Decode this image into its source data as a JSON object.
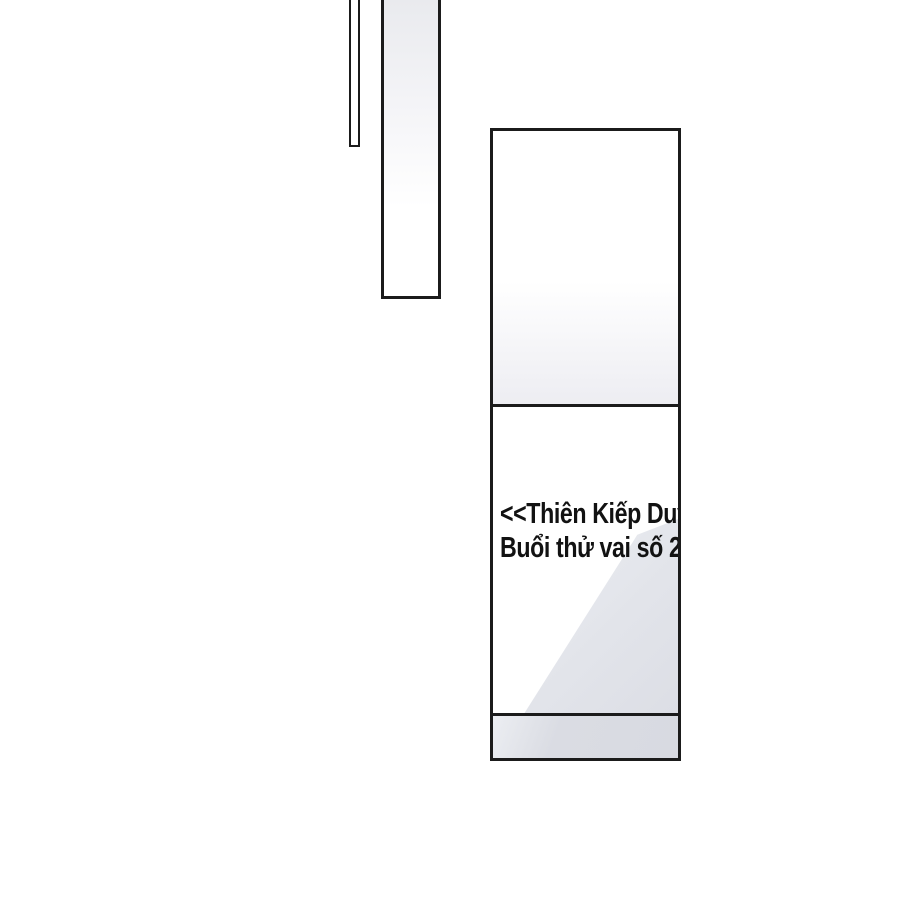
{
  "page": {
    "background": "#ffffff",
    "description_colors": {
      "ink_border": "#1b1b1b",
      "band_gray": "#d8dae1",
      "shade_gray": "#e2e4ea",
      "panel_tint": "#ededf2"
    }
  },
  "sign": {
    "line1": "<<Thiên Kiếp Duy",
    "line2": "Buổi thử vai số 2"
  }
}
